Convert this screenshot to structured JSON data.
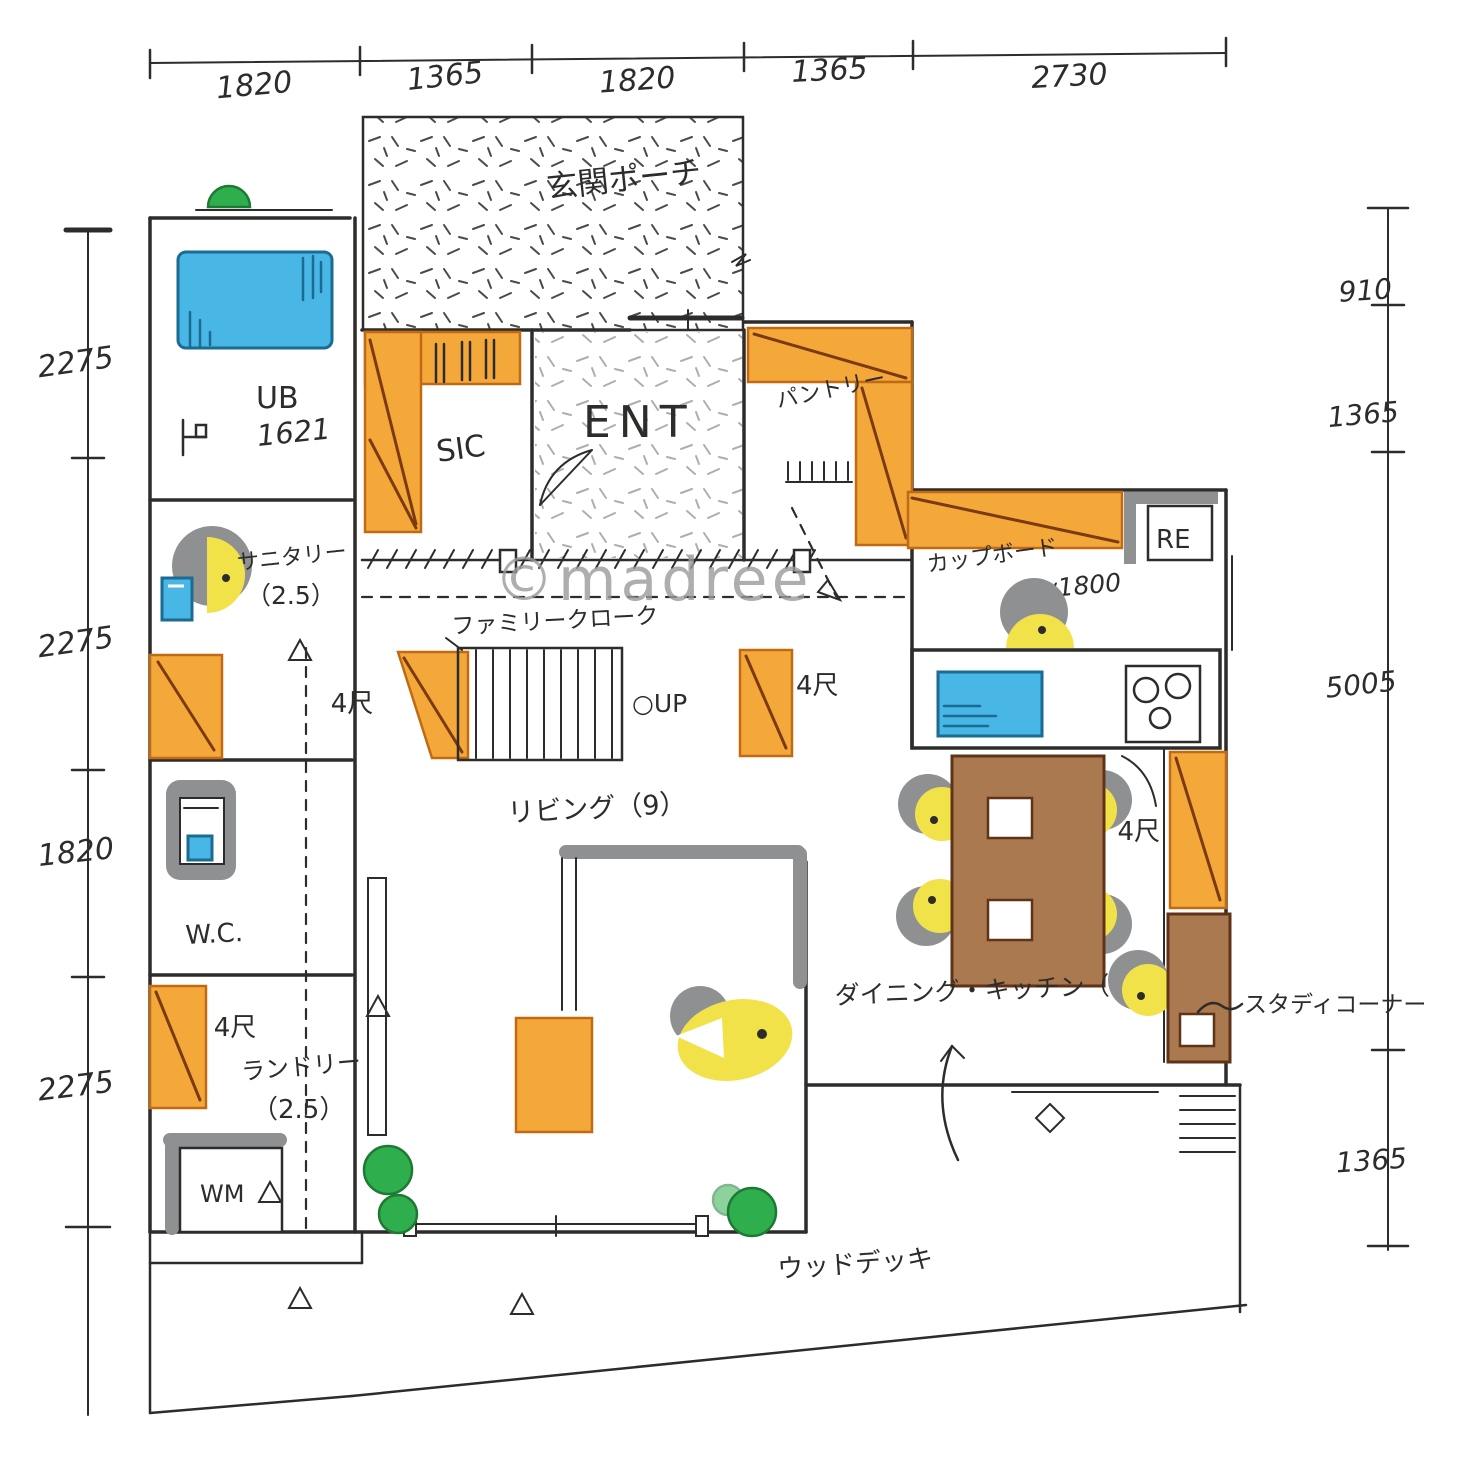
{
  "watermark": "©madree",
  "dimensions": {
    "top": [
      "1820",
      "1365",
      "1820",
      "1365",
      "2730"
    ],
    "left": [
      "2275",
      "2275",
      "1820",
      "2275"
    ],
    "right": [
      "910",
      "1365",
      "5005",
      "1365"
    ]
  },
  "labels": {
    "porch": "玄関ポーチ",
    "entrance": "ENT",
    "shoe_closet": "SIC",
    "bath": "UB",
    "bath_size": "1621",
    "sanitary": "サニタリー",
    "sanitary_area": "（2.5）",
    "pantry": "パントリー",
    "cupboard": "カップボード",
    "cupboard_width": "w1800",
    "fridge": "RE",
    "family_closet": "ファミリークローク",
    "stairs_up": "○UP",
    "living": "リビング（9）",
    "dining_kitchen": "ダイニング・キッチン（11）",
    "study_corner": "スタディコーナー",
    "toilet": "W.C.",
    "laundry": "ランドリー",
    "laundry_area": "（2.5）",
    "washer": "WM",
    "wood_deck": "ウッドデッキ",
    "closet": "4尺"
  },
  "colors": {
    "ink": "#2e2c2a",
    "orange": "#f4a83a",
    "orange_edge": "#c06a14",
    "orange_diag": "#7c3a12",
    "blue": "#49b7e6",
    "blue_edge": "#1b6b93",
    "yellow": "#f2e24a",
    "green": "#2fae4e",
    "green_edge": "#1d7a33",
    "brown": "#aa7950",
    "brown_edge": "#5f3318",
    "gray": "#8f9092",
    "watermark": "#9b9b9b"
  }
}
